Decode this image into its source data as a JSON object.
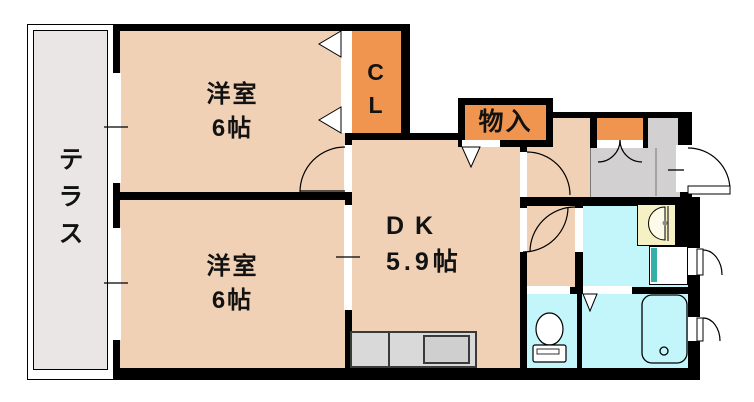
{
  "plan": {
    "terrace_label": "テラス",
    "bedroom_top": {
      "name": "洋室",
      "size": "6帖"
    },
    "bedroom_bottom": {
      "name": "洋室",
      "size": "6帖"
    },
    "dk": {
      "name": "DK",
      "size": "5.9帖"
    },
    "closet": {
      "char1": "C",
      "char2": "L"
    },
    "storage_label": "物入"
  },
  "colors": {
    "room_floor": "#F0D1B6",
    "closet_orange": "#F0954F",
    "wet_area_cyan": "#C3F6FB",
    "terrace_gray": "#EAE6E6",
    "entry_gray": "#D2D0D0",
    "counter_gray": "#D9D9D9",
    "sink_gray": "#CFCFCF",
    "basin_yellow": "#F5F1C4",
    "washer_teal": "#35B0A8",
    "wall_black": "#000000"
  }
}
